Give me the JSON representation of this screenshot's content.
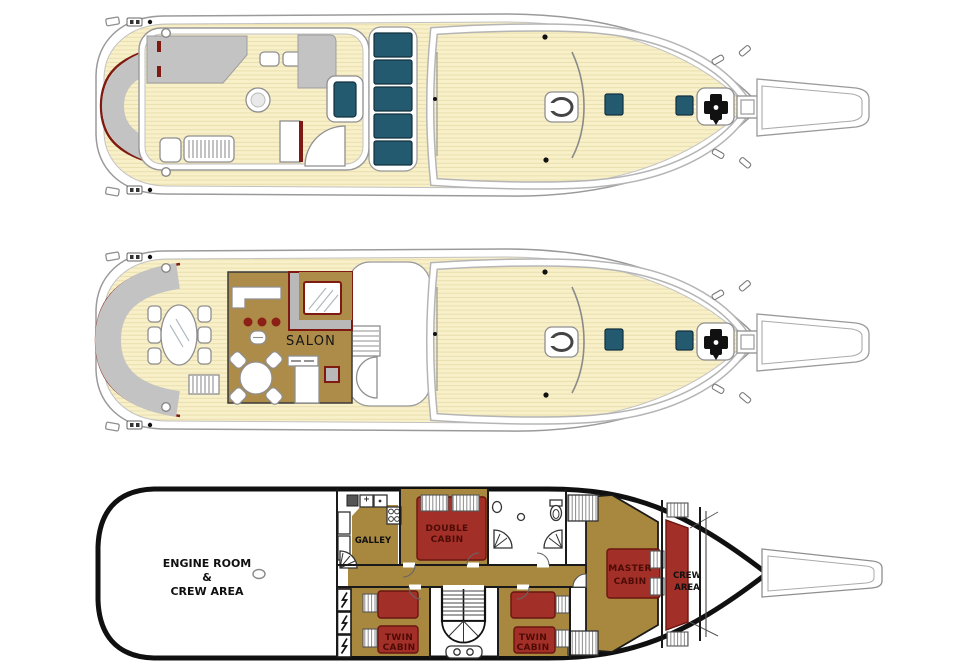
{
  "canvas": {
    "width": 962,
    "height": 668,
    "background": "#ffffff"
  },
  "palette": {
    "deck_plank": "#f8f0c9",
    "plank_line": "#eadfae",
    "hull_line": "#9a9a9a",
    "hull_black": "#101010",
    "seat_gray": "#c3c3c3",
    "trim_maroon": "#7e1a12",
    "glass_teal": "#235a70",
    "floor_gold": "#ad8c4a",
    "floor_gold_lower": "#a8873f",
    "bed_red": "#a33028",
    "bed_label_red": "#4d0b06",
    "text_black": "#101010"
  },
  "icons": {
    "windlass": "anchor-windlass-icon",
    "deck_hatch": "teal-deck-hatch-icon",
    "oval_hatch": "oval-deck-hatch-icon",
    "cleat": "mooring-cleat-icon",
    "lightning_bolt": "electrical-bolt-icon",
    "shower": "corner-shower-icon",
    "toilet": "toilet-icon",
    "sink": "sink-icon",
    "stairs": "staircase-icon"
  },
  "decks": {
    "sun_deck": {},
    "main_deck": {
      "salon_label": "SALON"
    },
    "lower_deck": {
      "engine_room_label": [
        "ENGINE ROOM",
        "&",
        "CREW AREA"
      ],
      "galley_label": "GALLEY",
      "double_cabin_label": [
        "DOUBLE",
        "CABIN"
      ],
      "twin_cabin_aft_label": [
        "TWIN",
        "CABIN"
      ],
      "twin_cabin_mid_label": [
        "TWIN",
        "CABIN"
      ],
      "master_cabin_label": [
        "MASTER",
        "CABIN"
      ],
      "crew_area_label": [
        "CREW",
        "AREA"
      ]
    }
  }
}
